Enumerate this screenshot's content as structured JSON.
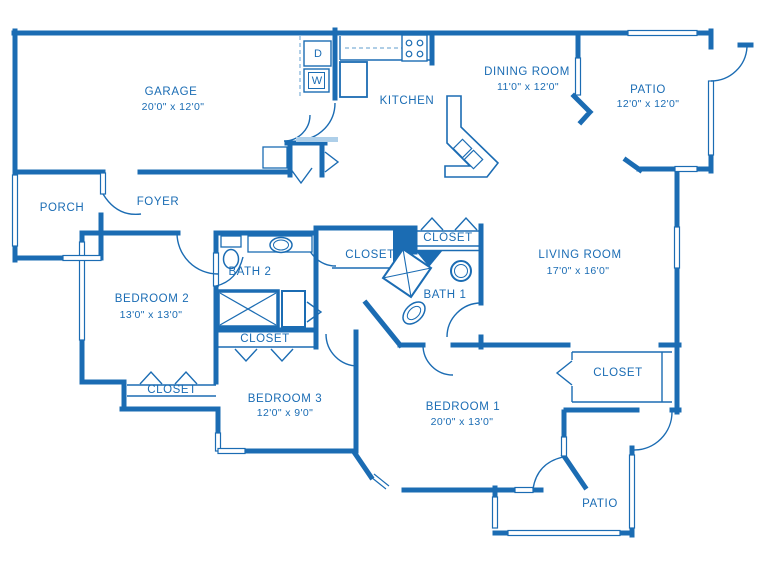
{
  "diagram_type": "floor-plan",
  "colors": {
    "wall": "#1b6cb3",
    "light": "#aecfe9",
    "dash": "#7fb0d8",
    "background": "#ffffff"
  },
  "rooms": {
    "garage": {
      "name": "GARAGE",
      "dims": "20'0\" x 12'0\""
    },
    "kitchen": {
      "name": "KITCHEN"
    },
    "dining": {
      "name": "DINING ROOM",
      "dims": "11'0\" x 12'0\""
    },
    "patio_top": {
      "name": "PATIO",
      "dims": "12'0\" x 12'0\""
    },
    "porch": {
      "name": "PORCH"
    },
    "foyer": {
      "name": "FOYER"
    },
    "bath2": {
      "name": "BATH 2"
    },
    "bath1": {
      "name": "BATH 1"
    },
    "living": {
      "name": "LIVING ROOM",
      "dims": "17'0\" x 16'0\""
    },
    "bedroom2": {
      "name": "BEDROOM 2",
      "dims": "13'0\" x 13'0\""
    },
    "bedroom3": {
      "name": "BEDROOM 3",
      "dims": "12'0\" x 9'0\""
    },
    "bedroom1": {
      "name": "BEDROOM 1",
      "dims": "20'0\" x 13'0\""
    },
    "patio_bottom": {
      "name": "PATIO"
    },
    "closet_hall": {
      "name": "CLOSET"
    },
    "closet_bath1": {
      "name": "CLOSET"
    },
    "closet_bath2_hall": {
      "name": "CLOSET"
    },
    "closet_bedroom2": {
      "name": "CLOSET"
    },
    "closet_bedroom1": {
      "name": "CLOSET"
    }
  },
  "appliances": {
    "dryer": "D",
    "washer": "W"
  }
}
